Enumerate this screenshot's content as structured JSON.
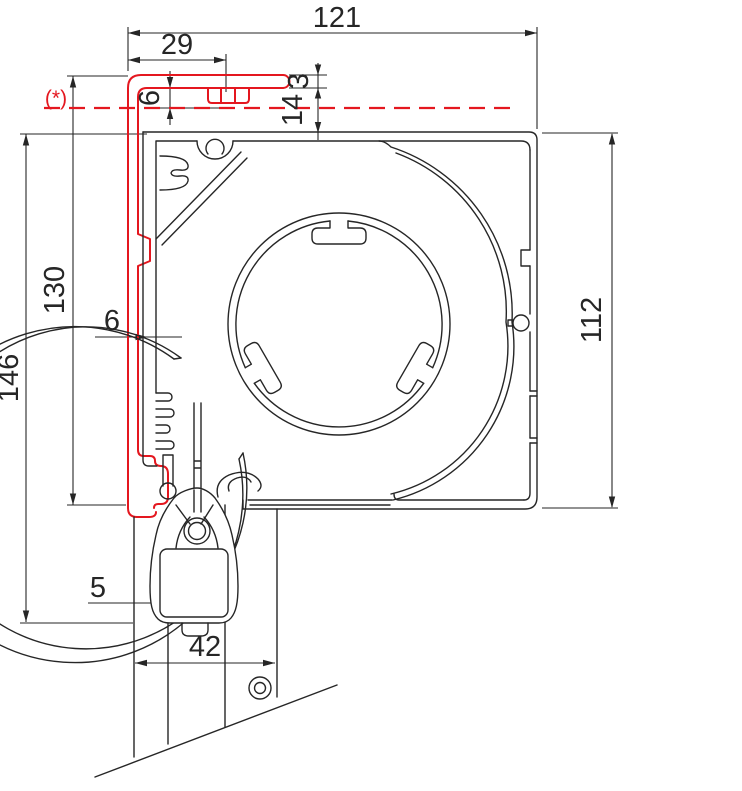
{
  "drawing": {
    "type": "technical-cross-section-roller-shutter-box",
    "reference_note": "(*)",
    "dimensions": {
      "overall_width": "121",
      "bracket_offset": "29",
      "gap_under_plate": "6",
      "plate_thickness": "3",
      "top_clearance": "14",
      "total_height": "146",
      "adapter_height": "130",
      "side_offset": "6",
      "box_height": "112",
      "slat_wall": "5",
      "rail_width": "42"
    },
    "colors": {
      "line": "#262626",
      "accent_red": "#e4171f",
      "background": "#ffffff"
    }
  }
}
